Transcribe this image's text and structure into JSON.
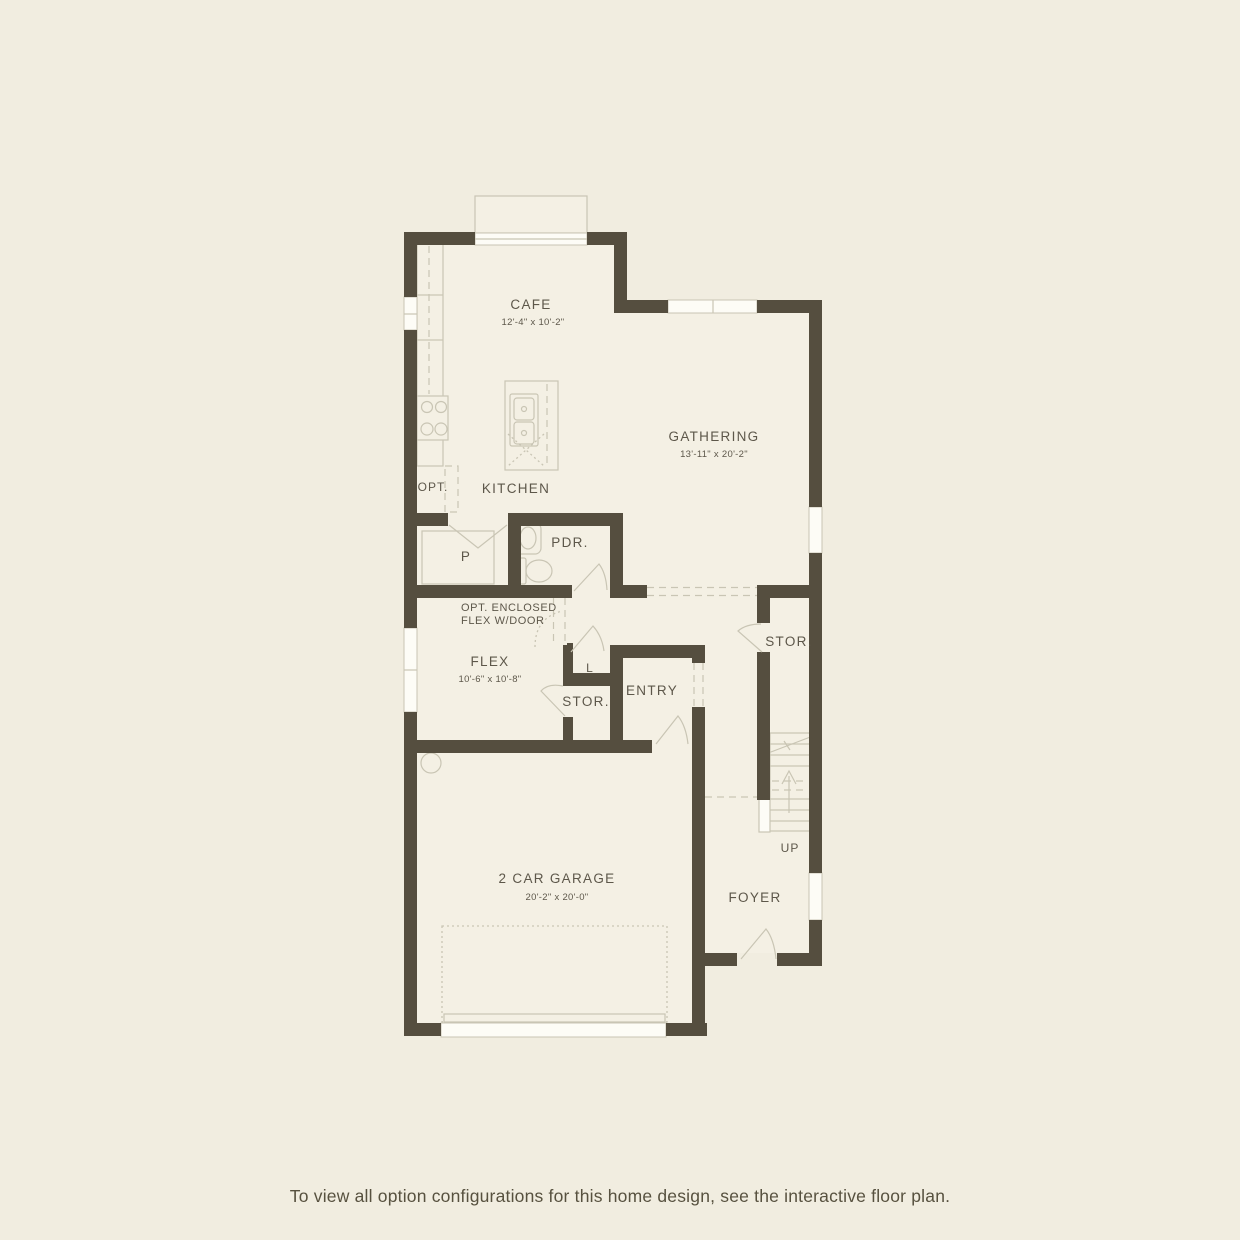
{
  "colors": {
    "background": "#f1ede0",
    "floor": "#f4f0e4",
    "wall": "#554e3f",
    "line": "#c9c5b4",
    "white": "#fdfcf6",
    "text": "#5d574a"
  },
  "plan": {
    "rooms": {
      "cafe": {
        "label": "CAFE",
        "dims": "12'-4\" x 10'-2\""
      },
      "kitchen": {
        "label": "KITCHEN"
      },
      "gathering": {
        "label": "GATHERING",
        "dims": "13'-11\" x 20'-2\""
      },
      "opt_appliance": {
        "label": "OPT."
      },
      "pantry": {
        "label": "P"
      },
      "powder": {
        "label": "PDR."
      },
      "flex": {
        "label": "FLEX",
        "dims": "10'-6\" x 10'-8\"",
        "option_note_line1": "OPT. ENCLOSED",
        "option_note_line2": "FLEX W/DOOR"
      },
      "linen": {
        "label": "L"
      },
      "storage": {
        "label": "STOR."
      },
      "entry": {
        "label": "ENTRY"
      },
      "storage_understair": {
        "label": "STOR."
      },
      "stairs": {
        "label": "UP"
      },
      "foyer": {
        "label": "FOYER"
      },
      "garage": {
        "label": "2 CAR GARAGE",
        "dims": "20'-2\" x 20'-0\""
      }
    }
  },
  "footer": {
    "caption": "To view all option configurations for this home design, see the interactive floor plan."
  }
}
